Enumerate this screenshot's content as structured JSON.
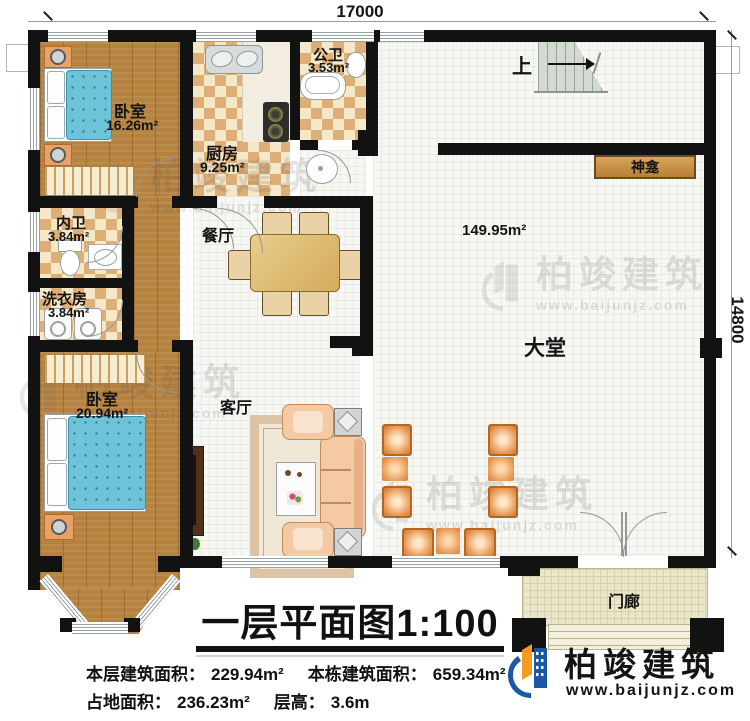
{
  "dims": {
    "width": "17000",
    "height": "14800"
  },
  "rooms": {
    "bedroom_top": {
      "name": "卧室",
      "area": "16.26m²"
    },
    "ensuite": {
      "name": "内卫",
      "area": "3.84m²"
    },
    "laundry": {
      "name": "洗衣房",
      "area": "3.84m²"
    },
    "bedroom_bottom": {
      "name": "卧室",
      "area": "20.94m²"
    },
    "kitchen": {
      "name": "厨房",
      "area": "9.25m²"
    },
    "public_bath": {
      "name": "公卫",
      "area": "3.53m²"
    },
    "dining": {
      "name": "餐厅"
    },
    "living": {
      "name": "客厅"
    },
    "hall": {
      "name": "大堂",
      "area": "149.95m²"
    },
    "porch": {
      "name": "门廊"
    },
    "shrine": {
      "name": "神龛"
    },
    "stairs": {
      "direction": "上"
    }
  },
  "title": {
    "main": "一层平面图",
    "scale": "1:100"
  },
  "stats": {
    "floor_area": {
      "label": "本层建筑面积：",
      "value": "229.94m²"
    },
    "building_area": {
      "label": "本栋建筑面积：",
      "value": "659.34m²"
    },
    "land_area": {
      "label": "占地面积：",
      "value": "236.23m²"
    },
    "floor_height": {
      "label": "层高：",
      "value": "3.6m"
    }
  },
  "brand": {
    "company": "柏竣建筑",
    "website": "www.baijunjz.com"
  },
  "colors": {
    "wall": "#121212",
    "wood": "#b5823f",
    "tile_dark": "#ddae76",
    "tile_light": "#f5e8c8",
    "bed_blue": "#6fc3d8",
    "brand_blue": "#1c59a5",
    "brand_orange": "#f59a1d"
  }
}
